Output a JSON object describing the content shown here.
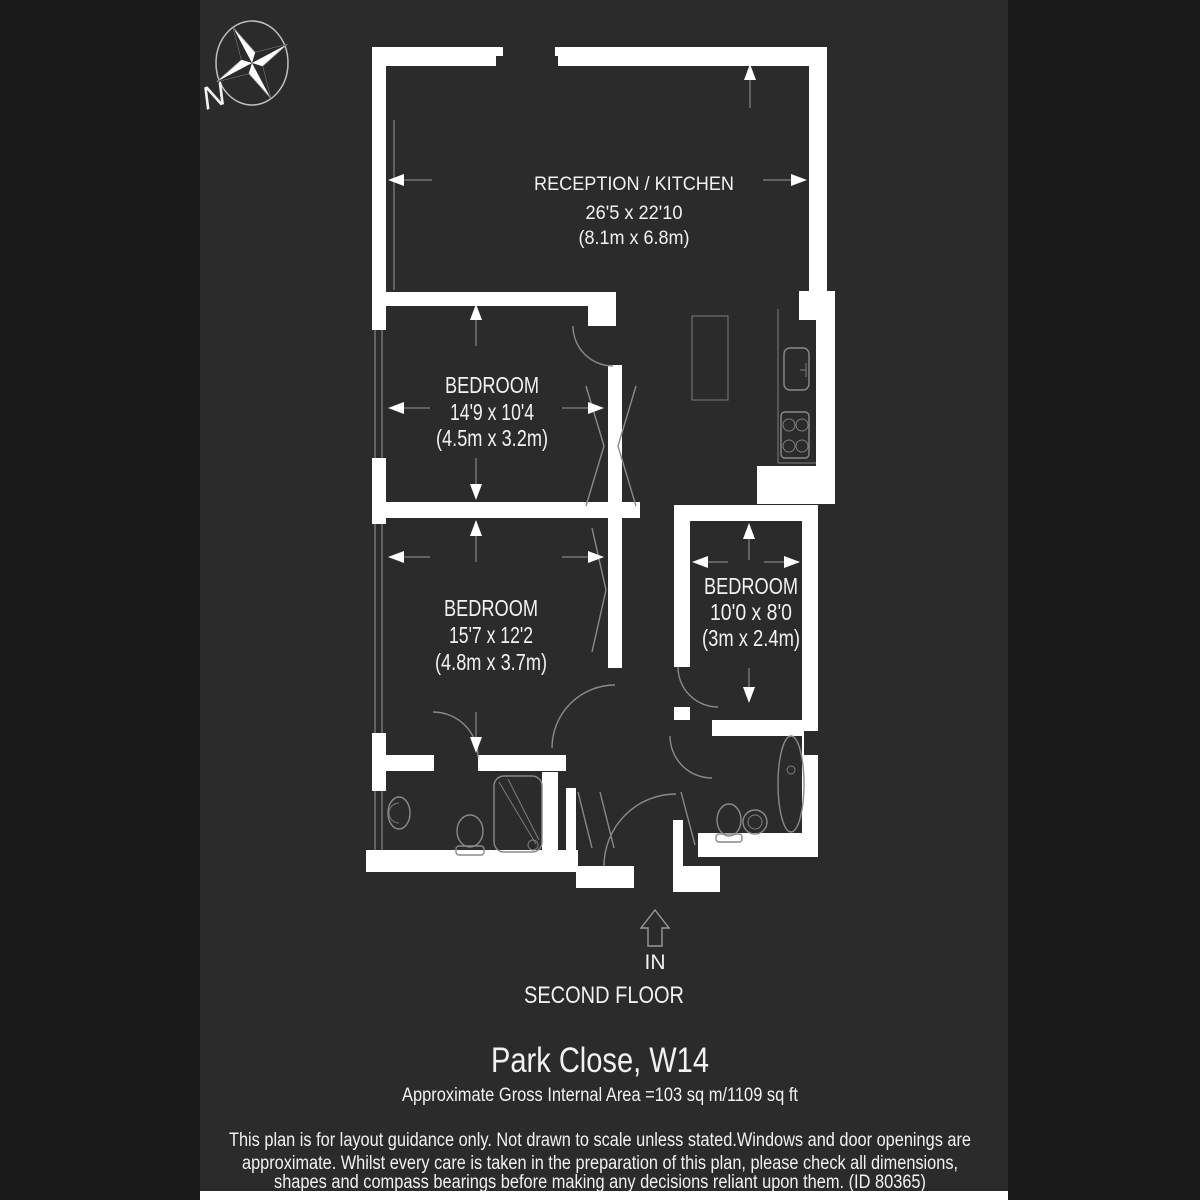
{
  "page": {
    "background": "#1a1a1a",
    "panel_background": "#2b2b2b",
    "wall_color": "#ffffff",
    "fixture_line_color": "#8a8a8a",
    "text_color": "#f2f2f2"
  },
  "compass": {
    "label": "N"
  },
  "entrance": {
    "label": "IN"
  },
  "rooms": [
    {
      "id": "reception-kitchen",
      "name": "RECEPTION / KITCHEN",
      "dims_imperial": "26'5 x 22'10",
      "dims_metric": "(8.1m x 6.8m)"
    },
    {
      "id": "bedroom-1",
      "name": "BEDROOM",
      "dims_imperial": "14'9 x 10'4",
      "dims_metric": "(4.5m x 3.2m)"
    },
    {
      "id": "bedroom-2",
      "name": "BEDROOM",
      "dims_imperial": "15'7 x 12'2",
      "dims_metric": "(4.8m x 3.7m)"
    },
    {
      "id": "bedroom-3",
      "name": "BEDROOM",
      "dims_imperial": "10'0 x 8'0",
      "dims_metric": "(3m x 2.4m)"
    }
  ],
  "footer": {
    "floor_label": "SECOND FLOOR",
    "title": "Park Close, W14",
    "area_line": "Approximate Gross Internal Area =103 sq m/1109 sq ft",
    "disclaimer_line1": "This plan is for layout guidance only. Not drawn to scale unless stated.Windows and door openings are",
    "disclaimer_line2": "approximate. Whilst every care is taken in the preparation of this plan, please check all dimensions,",
    "disclaimer_line3": "shapes and compass bearings before making any decisions reliant upon them. (ID 80365)"
  }
}
